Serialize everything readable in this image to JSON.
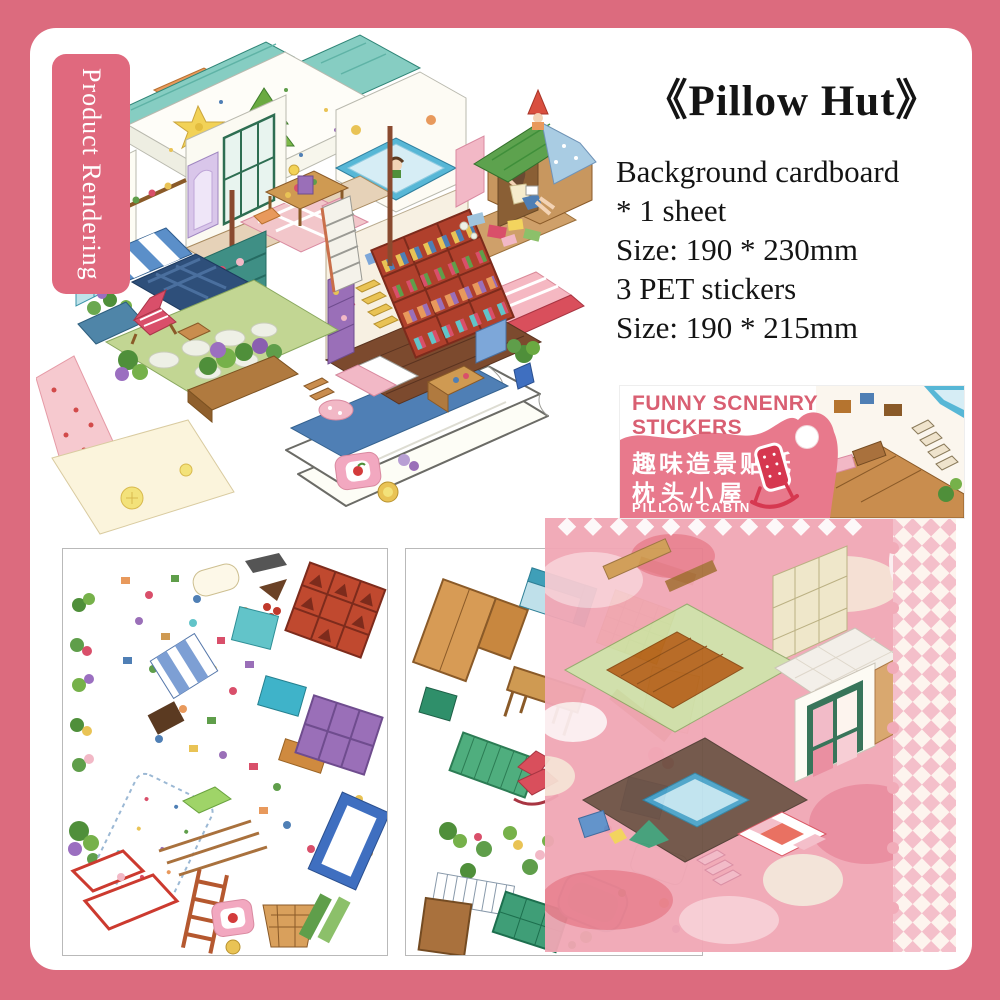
{
  "frame": {
    "border_color": "#dc6b7e",
    "panel_color": "#ffffff"
  },
  "ribbon": {
    "label": "Product Rendering",
    "bg": "#e0697e"
  },
  "product_info": {
    "title": "《Pillow Hut》",
    "lines": [
      "Background cardboard",
      "* 1 sheet",
      "Size: 190 * 230mm",
      "3 PET stickers",
      "Size: 190 * 215mm"
    ]
  },
  "package_label": {
    "brand_line1": "FUNNY SCNENRY",
    "brand_line2": "STICKERS",
    "chinese_title": "趣味造景贴纸",
    "chinese_subtitle": "枕头小屋",
    "english_subtitle": "PILLOW CABIN",
    "accent_color": "#d95f72",
    "blob_color": "#e8798c",
    "icons": [
      "rocking-chair-icon",
      "hang-hole"
    ]
  },
  "sheets": {
    "left_sheet": "pet-sticker-sheet-1",
    "middle_sheet": "pet-sticker-sheet-2",
    "background_sheet": "pink-background-cardboard"
  },
  "illustration": {
    "scene": "isometric-pillow-hut-dollhouse",
    "side_scene": "cardboard-hut-reading-girl"
  }
}
